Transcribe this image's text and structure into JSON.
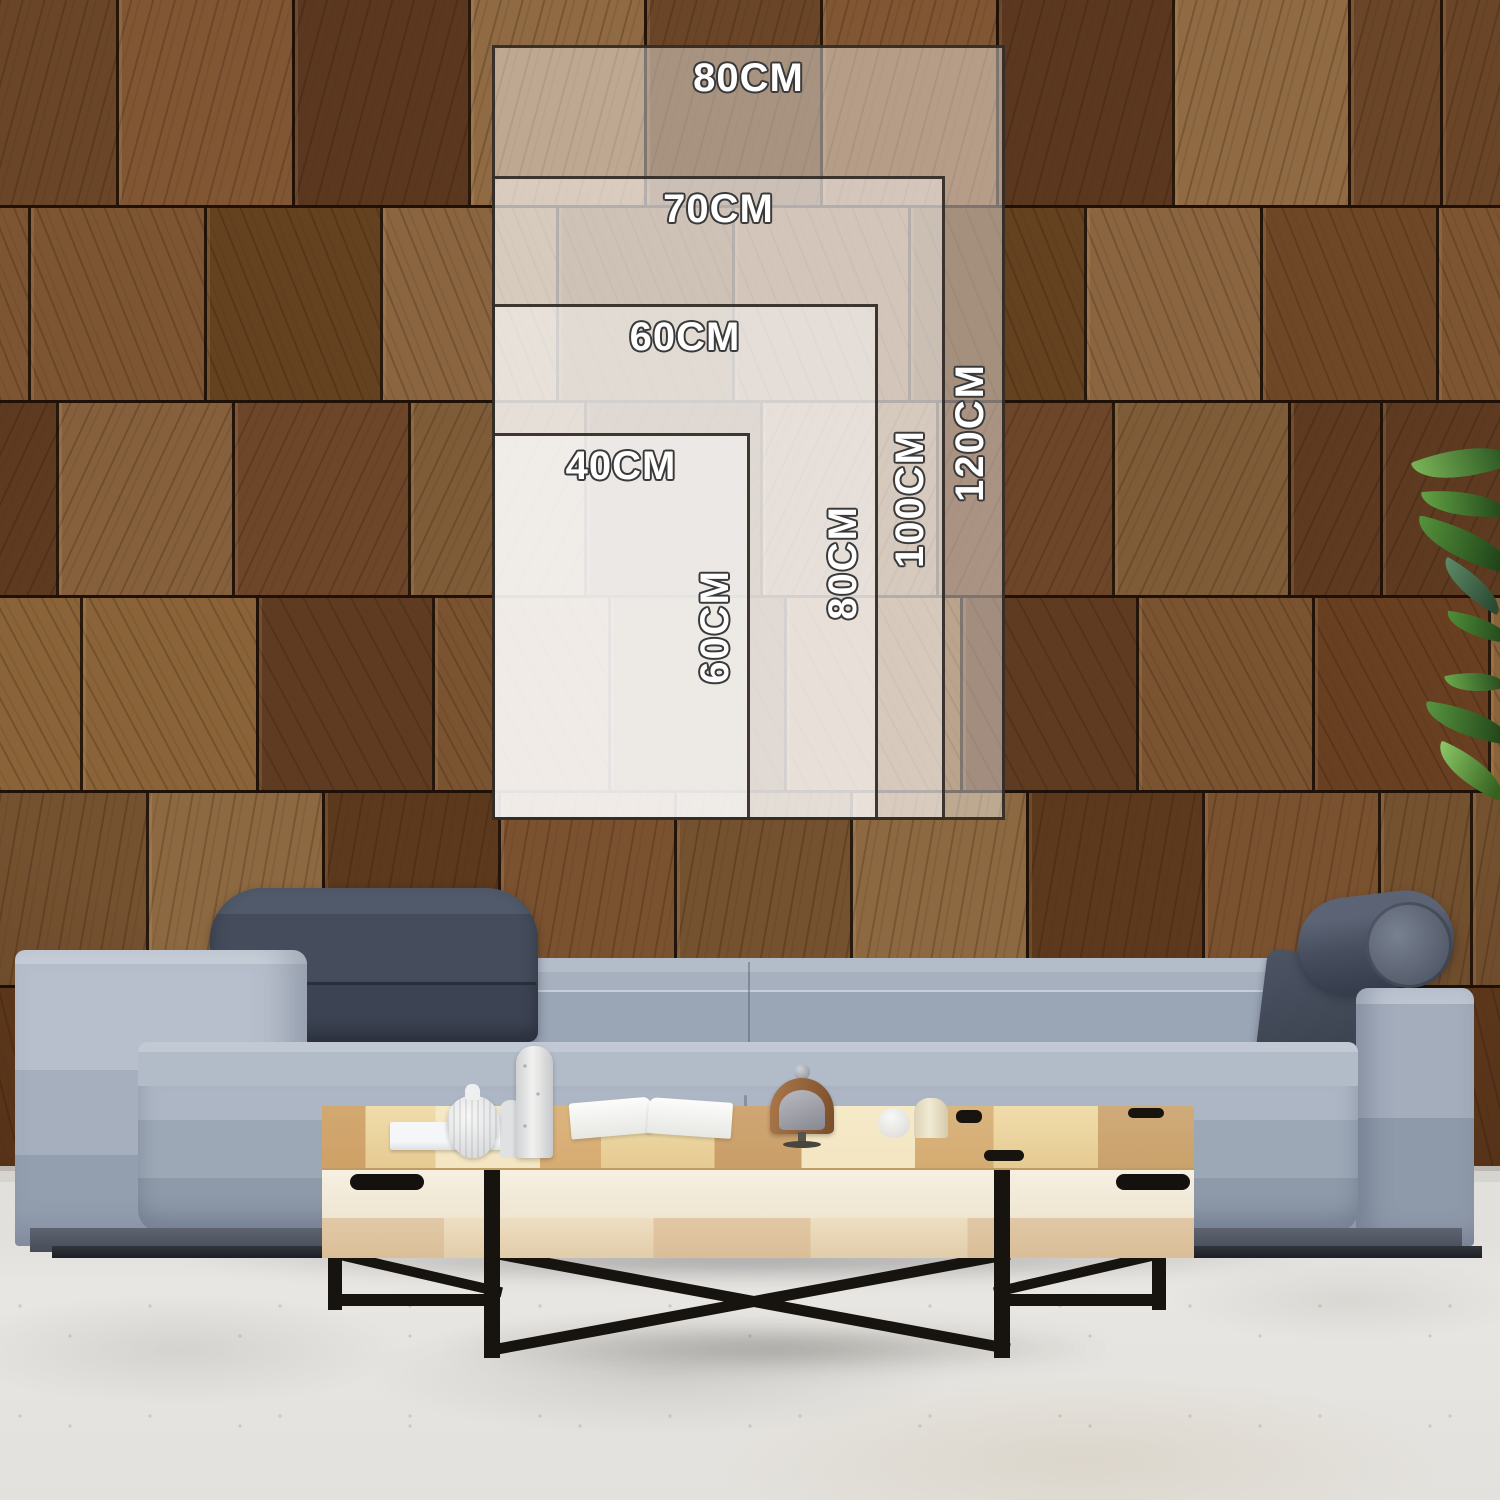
{
  "page": {
    "type": "product-size-guide-photo",
    "description": "Canvas print size comparison chart overlaid on a wood-block wall above a grey sofa with a coffee table"
  },
  "size_guide": {
    "unit": "CM",
    "options": [
      {
        "id": "80x120",
        "width": "80CM",
        "height": "120CM"
      },
      {
        "id": "70x100",
        "width": "70CM",
        "height": "100CM"
      },
      {
        "id": "60x80",
        "width": "60CM",
        "height": "80CM"
      },
      {
        "id": "40x60",
        "width": "40CM",
        "height": "60CM"
      }
    ]
  },
  "colors": {
    "overlay_fill": "rgba(255,255,255,0.42)",
    "overlay_border": "#2a241e",
    "label_fill": "#ffffff",
    "label_outline": "#3a3a3a",
    "wall_wood": "#7b5431",
    "sofa_fabric": "#a6b0bf",
    "headrest_dark": "#454d5d",
    "table_wood": "#e6cb92",
    "table_body": "#f3edde",
    "table_legs": "#17130f",
    "floor": "#e2e0dc",
    "plant_green": "#55923c"
  }
}
